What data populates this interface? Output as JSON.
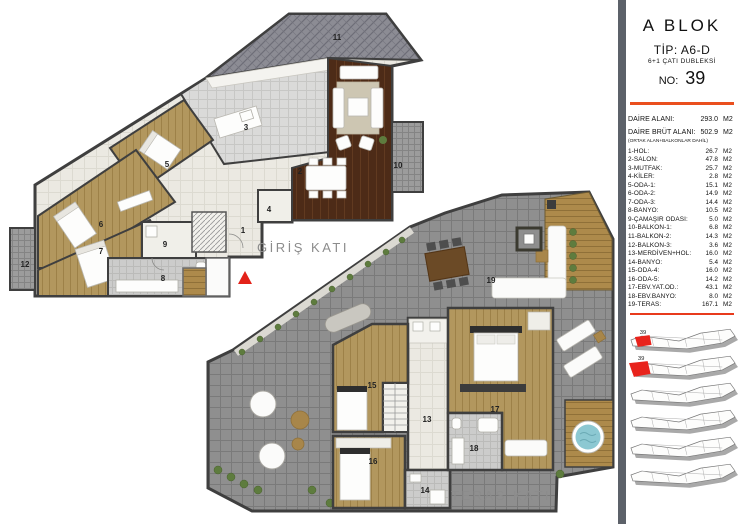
{
  "sidebar": {
    "block_title": "A  BLOK",
    "type_label": "TİP: A6-D",
    "subtype_label": "6+1 ÇATI DUBLEKSİ",
    "no_label": "NO:",
    "no_value": "39",
    "unit": "M2",
    "area_rows": [
      {
        "name": "DAİRE ALANI:",
        "value": "293.0"
      },
      {
        "name": "DAİRE BRÜT ALANI:",
        "value": "502.9"
      }
    ],
    "area_note": "(ORTAK ALAN+BALKONLAR DAHİL)",
    "rooms": [
      {
        "name": "1-HOL:",
        "value": "26.7"
      },
      {
        "name": "2-SALON:",
        "value": "47.8"
      },
      {
        "name": "3-MUTFAK:",
        "value": "25.7"
      },
      {
        "name": "4-KİLER:",
        "value": "2.8"
      },
      {
        "name": "5-ODA-1:",
        "value": "15.1"
      },
      {
        "name": "6-ODA-2:",
        "value": "14.9"
      },
      {
        "name": "7-ODA-3:",
        "value": "14.4"
      },
      {
        "name": "8-BANYO:",
        "value": "10.5"
      },
      {
        "name": "9-ÇAMAŞIR ODASI:",
        "value": "5.0"
      },
      {
        "name": "10-BALKON-1:",
        "value": "6.8"
      },
      {
        "name": "11-BALKON-2:",
        "value": "14.3"
      },
      {
        "name": "12-BALKON-3:",
        "value": "3.6"
      },
      {
        "name": "13-MERDİVEN+HOL:",
        "value": "16.0"
      },
      {
        "name": "14-BANYO:",
        "value": "5.4"
      },
      {
        "name": "15-ODA-4:",
        "value": "16.0"
      },
      {
        "name": "16-ODA-5:",
        "value": "14.2"
      },
      {
        "name": "17-EBV.YAT.OD.:",
        "value": "43.1"
      },
      {
        "name": "18-EBV.BANYO:",
        "value": "8.0"
      },
      {
        "name": "19-TERAS:",
        "value": "167.1"
      }
    ]
  },
  "plans": {
    "giris": {
      "label": "GİRİŞ KATI",
      "rooms": [
        "1",
        "2",
        "3",
        "4",
        "5",
        "6",
        "7",
        "8",
        "9",
        "10",
        "11",
        "12"
      ]
    },
    "teras": {
      "label": "TERAS KATI",
      "rooms": [
        "13",
        "14",
        "15",
        "16",
        "17",
        "18",
        "19"
      ]
    }
  },
  "keyplans": {
    "unit_label": "39",
    "count": 6
  },
  "colors": {
    "accent_orange": "#EA4F1E",
    "highlight_red": "#E8231C",
    "wall": "#3F3F3F",
    "wood_light": "#B2975E",
    "wood_dark": "#4D2B17",
    "terrace_tile": "#8F8F8F",
    "sidebar_strip": "#5C6169"
  }
}
